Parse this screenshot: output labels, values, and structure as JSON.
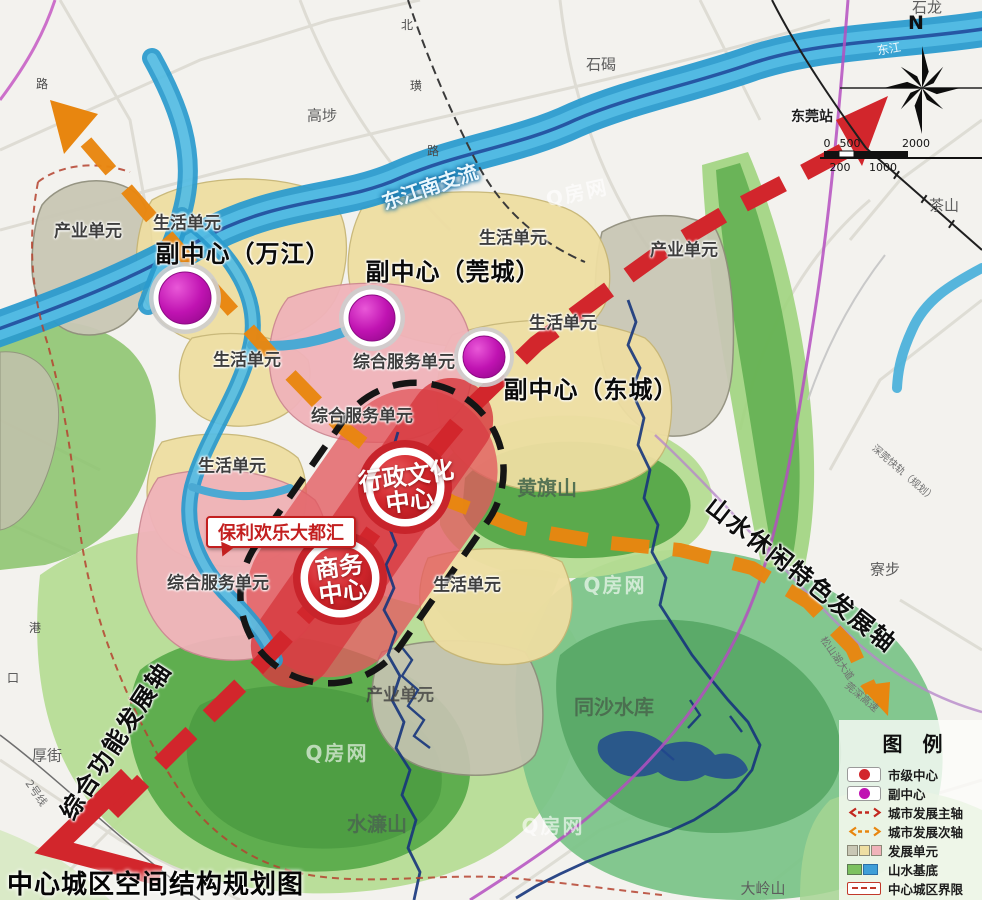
{
  "title": "中心城区空间结构规划图",
  "watermark": "Q房网",
  "compass": {
    "north": "N"
  },
  "scale": {
    "top": [
      "0",
      "500",
      "2000"
    ],
    "bottom": [
      "200",
      "1000"
    ]
  },
  "legend": {
    "title": "图　例",
    "items": [
      {
        "label": "市级中心",
        "color": "#d2262c"
      },
      {
        "label": "副中心",
        "color": "#c013b2"
      },
      {
        "label": "城市发展主轴",
        "color": "#d2262c"
      },
      {
        "label": "城市发展次轴",
        "color": "#e8860f"
      },
      {
        "label": "发展单元",
        "colors": [
          "#c9c7b5",
          "#eedea2",
          "#f0b3ba"
        ]
      },
      {
        "label": "山水基底",
        "colors": [
          "#7cc160",
          "#3f9fd8"
        ]
      },
      {
        "label": "中心城区界限",
        "color": "#c2392b"
      }
    ]
  },
  "axes": {
    "main": "综合功能发展轴",
    "secondary": "山水休闲特色发展轴"
  },
  "sub_centers": [
    "副中心（万江）",
    "副中心（莞城）",
    "副中心（东城）"
  ],
  "city_centers": [
    {
      "line1": "行政文化",
      "line2": "中心"
    },
    {
      "line1": "商务",
      "line2": "中心"
    }
  ],
  "callout": "保利欢乐大都汇",
  "units": {
    "living": "生活单元",
    "industry": "产业单元",
    "service": "综合服务单元"
  },
  "mountains": {
    "huangqi": "黄旗山",
    "tongsha": "同沙水库",
    "shuilian": "水濂山",
    "daling": "大岭山"
  },
  "places": {
    "shilong": "石龙",
    "shijie": "石碣",
    "gaobu": "高埗",
    "chashan": "茶山",
    "liaobu": "寮步",
    "houjie": "厚街",
    "station": "东莞站"
  },
  "rivers": {
    "dongjiang": "东江",
    "south_branch": "东江南支流"
  },
  "roads": {
    "lu_nw": "路",
    "bei": "北",
    "huang": "璜",
    "lu": "路",
    "gang": "港",
    "kou": "口",
    "line2": "2号线",
    "sz_rail": "深莞快轨（规划）",
    "songshanhu": "松山湖大道",
    "guanshen": "莞深高速"
  },
  "colors": {
    "main_axis": "#d2262c",
    "secondary_axis": "#e8860f",
    "city_center": "#d2262c",
    "sub_center": "#c013b2",
    "river": "#2b9bce",
    "green_base": "#7cc160"
  }
}
